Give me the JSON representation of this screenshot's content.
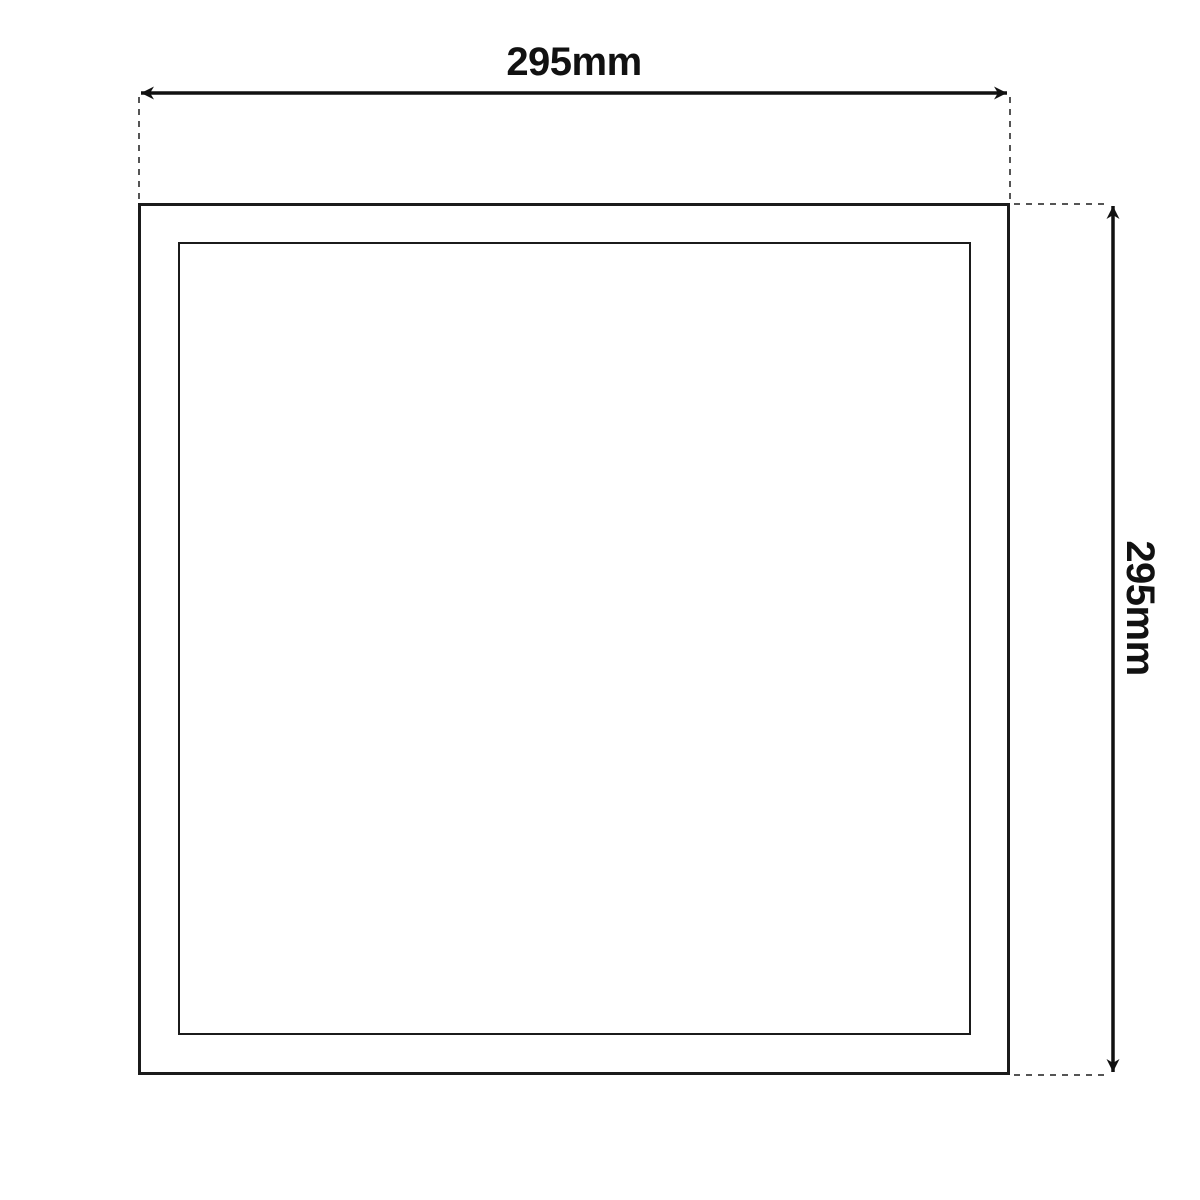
{
  "diagram": {
    "type": "technical-dimension-drawing",
    "subject": "square panel front view with inner frame",
    "width_dimension": {
      "label": "295mm",
      "orientation": "horizontal"
    },
    "height_dimension": {
      "label": "295mm",
      "orientation": "vertical"
    }
  },
  "colors": {
    "background": "#ffffff",
    "outline": "#1b1b1b",
    "dimension_line": "#111111",
    "extension_dash": "#555555",
    "label_text": "#111111"
  }
}
